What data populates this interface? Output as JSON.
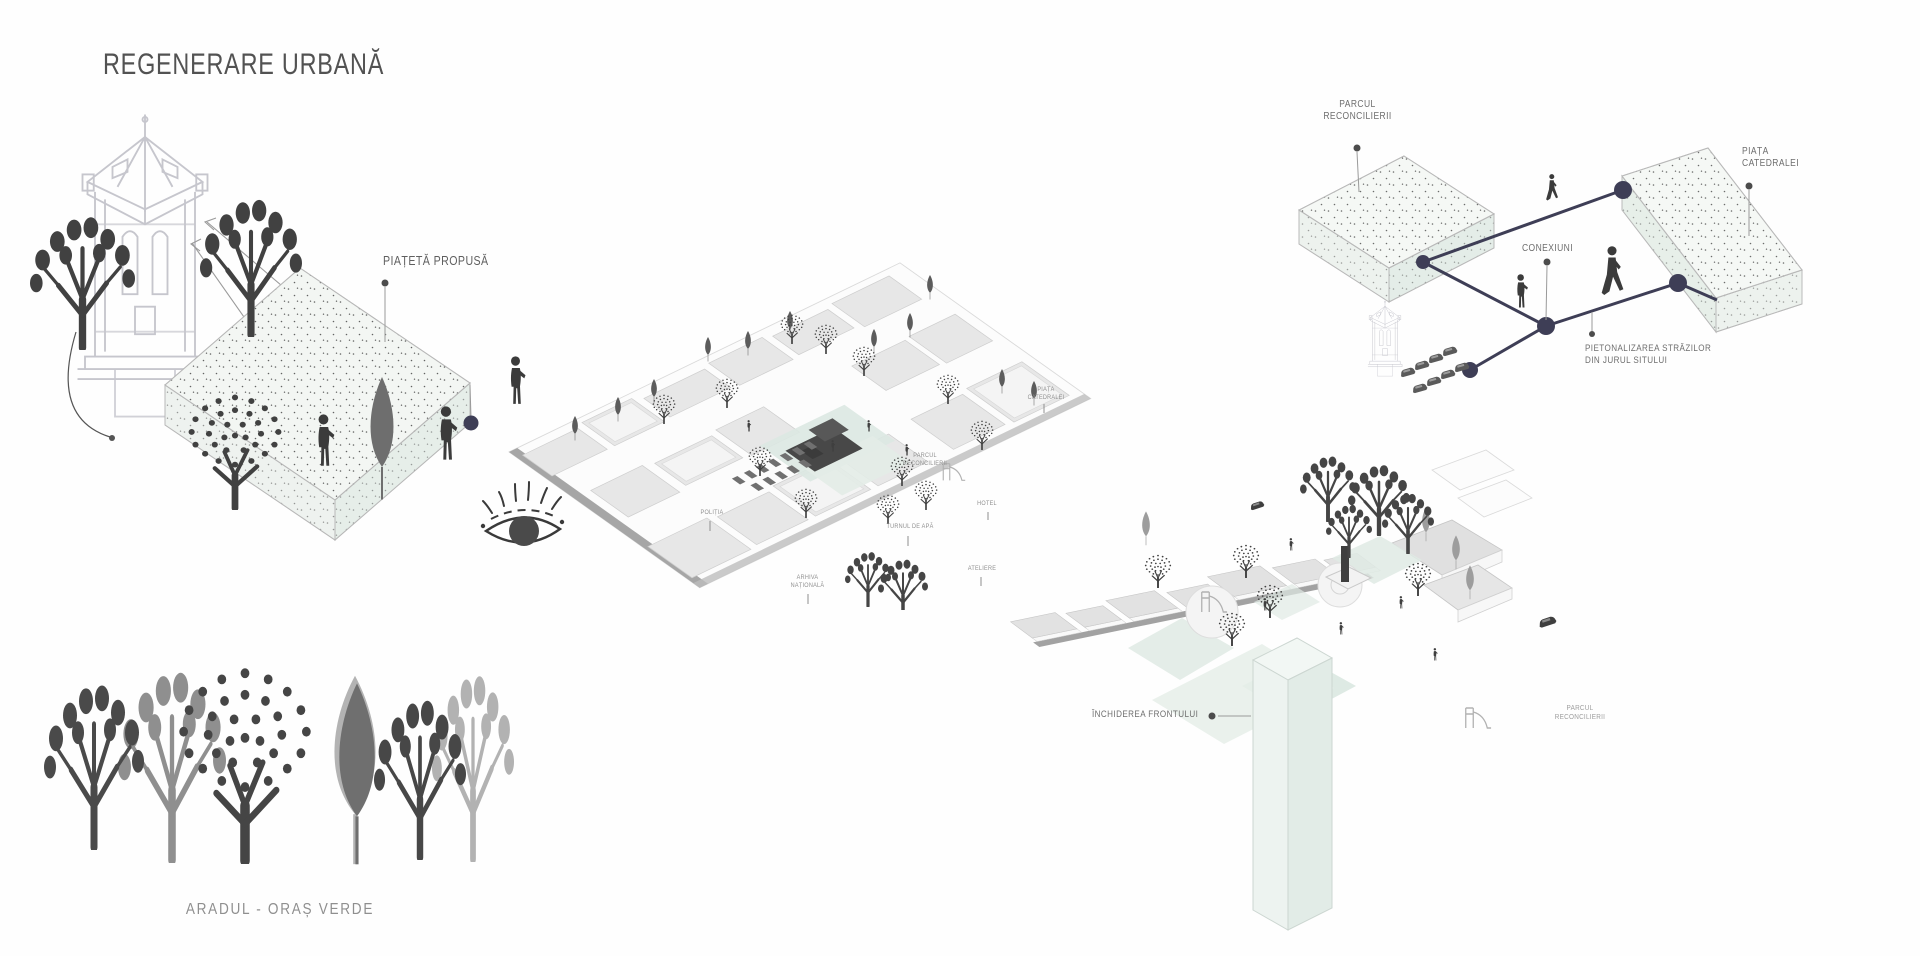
{
  "title": "REGENERARE URBANĂ",
  "colors": {
    "accent_navy": "#3e3e56",
    "mint": "#dbe7e1",
    "silhouette_dark": "#414141",
    "linework_gray": "#c6c6cd",
    "label_gray": "#6b6b6b",
    "road_gray": "#a2a2a2"
  },
  "proposed_plaza": {
    "label": "PIAȚETĂ PROPUSĂ"
  },
  "green_city": {
    "caption": "ARADUL - ORAȘ VERDE"
  },
  "site_map": {
    "labels": {
      "politia": "POLIȚIA",
      "arhiva_1": "ARHIVA",
      "arhiva_2": "NAȚIONALĂ",
      "parcul_1": "PARCUL",
      "parcul_2": "RECONCILIERII",
      "turnul": "TURNUL DE APĂ",
      "hotel": "HOTEL",
      "ateliere": "ATELIERE",
      "piata_1": "PIAȚA",
      "piata_2": "CATEDRALEI"
    }
  },
  "connections": {
    "parcul_1": "PARCUL",
    "parcul_2": "RECONCILIERII",
    "piata_1": "PIAȚA",
    "piata_2": "CATEDRALEI",
    "conexiuni": "CONEXIUNI",
    "pieton_1": "PIETONALIZAREA STRĂZILOR",
    "pieton_2": "DIN JURUL SITULUI"
  },
  "front_closure": {
    "label": "ÎNCHIDEREA FRONTULUI",
    "parcul_1": "PARCUL",
    "parcul_2": "RECONCILIERII"
  }
}
